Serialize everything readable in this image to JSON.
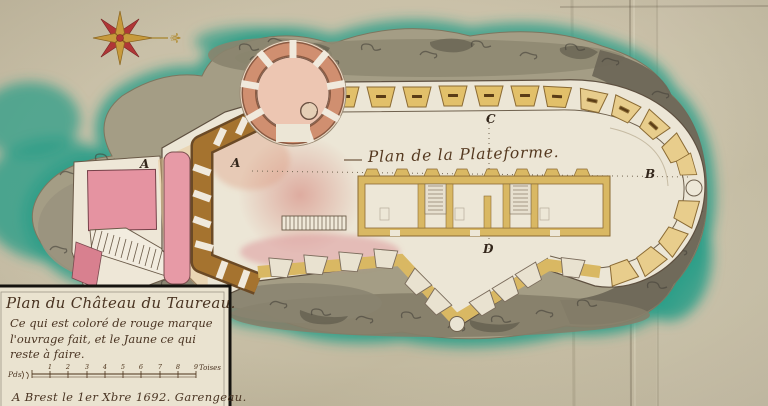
{
  "photo": {
    "subject": "Hand-drawn fortification plan of the Château du Taureau on its rocky island"
  },
  "plan": {
    "title": "Plan de la Plateforme.",
    "markers": [
      {
        "label": "A"
      },
      {
        "label": "A"
      },
      {
        "label": "B"
      },
      {
        "label": "C"
      },
      {
        "label": "D"
      }
    ]
  },
  "cartouche": {
    "lines": [
      "Plan du Château du Taureau.",
      "Ce qui est coloré de rouge marque",
      "l'ouvrage fait, et le Jaune ce qui",
      "reste à faire."
    ],
    "scale": {
      "left_label": "Pds",
      "unit_label": "Toises",
      "ticks": [
        "1",
        "2",
        "3",
        "4",
        "5",
        "6",
        "7",
        "8",
        "9"
      ]
    },
    "signature": "A Brest le 1er Xbre 1692. Garengeau."
  },
  "compass": {
    "east_symbol": "⚜"
  },
  "colors": {
    "paper": "#c9c0a6",
    "water": "#2b9e88",
    "rock": "#a49d85",
    "platform": "#ece6d6",
    "yellow_unbuilt": "#d9b863",
    "red_built": "#e593a1",
    "wall_brown": "#9a672c",
    "ink": "#4a3422"
  }
}
